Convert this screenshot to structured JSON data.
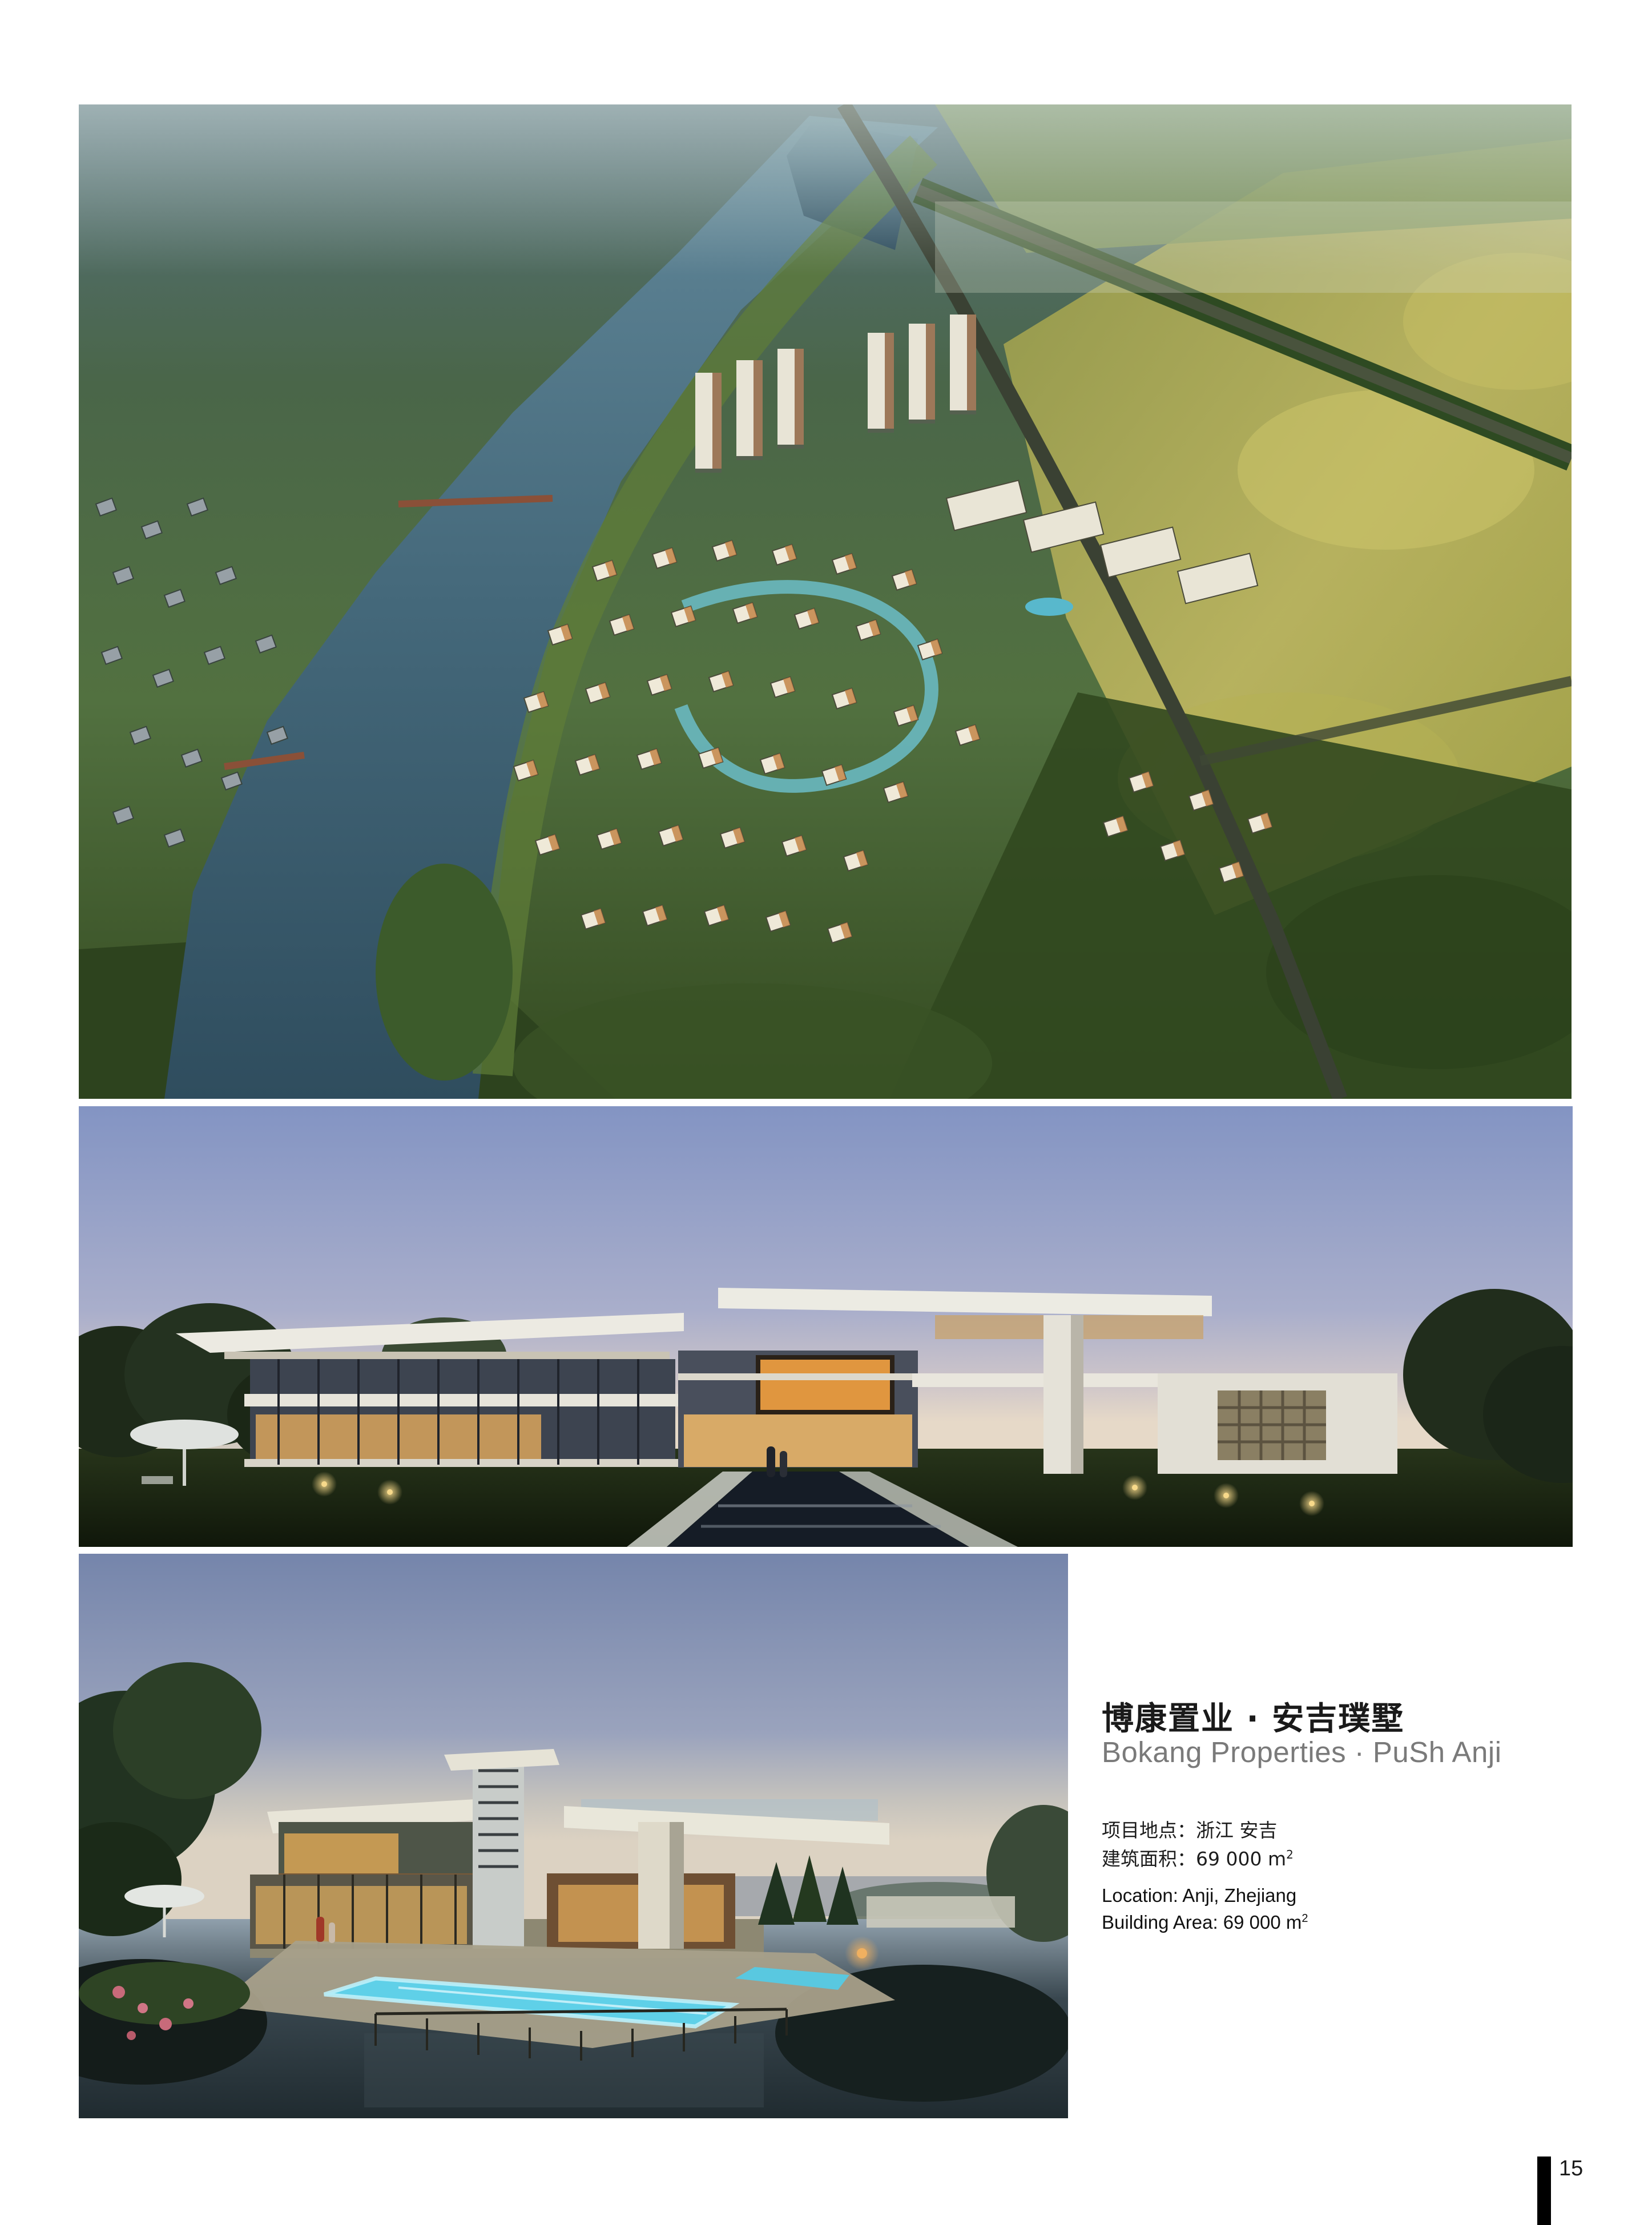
{
  "page": {
    "number": "15",
    "background_color": "#ffffff",
    "footer_bar_color": "#000000"
  },
  "project": {
    "title_zh": "博康置业 · 安吉璞墅",
    "title_en": "Bokang Properties · PuSh Anji",
    "title_color": "#1a1a1a",
    "subtitle_color": "#7a7a7a",
    "details_zh": {
      "location_label": "项目地点：",
      "location_value": "浙江 安吉",
      "area_label": "建筑面积：",
      "area_value": "69 000 m",
      "area_sup": "2"
    },
    "details_en": {
      "location": "Location: Anji, Zhejiang",
      "area": "Building Area: 69 000 m",
      "area_sup": "2"
    }
  },
  "images": {
    "aerial_masterplan": {
      "river_color": "#3f5f6c",
      "forest_color": "#47634a",
      "field_color": "#b3ad55",
      "villa_roof_color": "#efe9d8"
    },
    "villa_dusk": {
      "sky_top_color": "#8394c3",
      "horizon_color": "#e6d9c8",
      "window_glow_color": "#e0a254",
      "lawn_color": "#1c260f"
    },
    "villa_pool": {
      "sky_top_color": "#7585ab",
      "pool_glow_color": "#5fd0e8",
      "pond_color": "#232e33",
      "window_glow_color": "#d8a258"
    }
  }
}
